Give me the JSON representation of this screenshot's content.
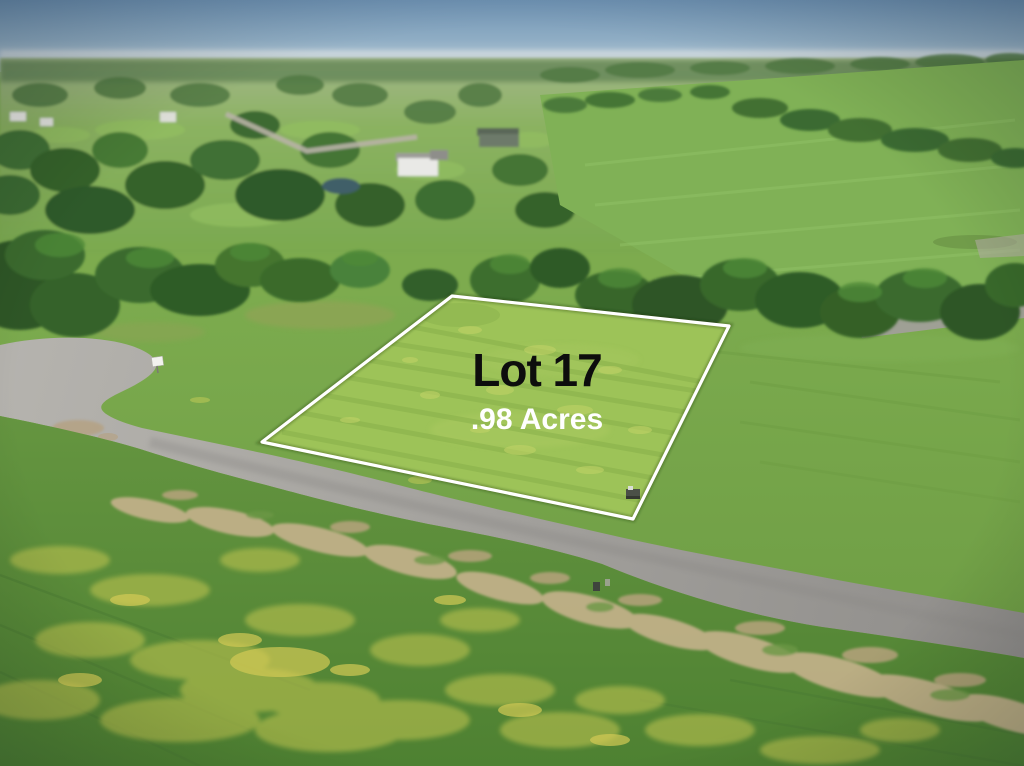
{
  "photo_overlay": {
    "lot_label": "Lot 17",
    "acres_label": ".98 Acres",
    "lot_label_color": "#0d0d0d",
    "acres_label_color": "#ffffff",
    "boundary_color": "#ffffff"
  },
  "scene_colors": {
    "sky": "#6e92b3",
    "horizon_haze": "#ccd7db",
    "distant_field": "#7fae55",
    "pasture": "#80b156",
    "tree_dark_green": "#2f5b28",
    "mid_grass": "#79a74a",
    "lot_grass": "#9dc358",
    "asphalt_road": "#9b9996",
    "dirt_shoulder": "#c2ae88",
    "foreground_grass": "#5e8f3c",
    "wildflower_yellow": "#c6c452",
    "pond_water": "#415f68"
  }
}
